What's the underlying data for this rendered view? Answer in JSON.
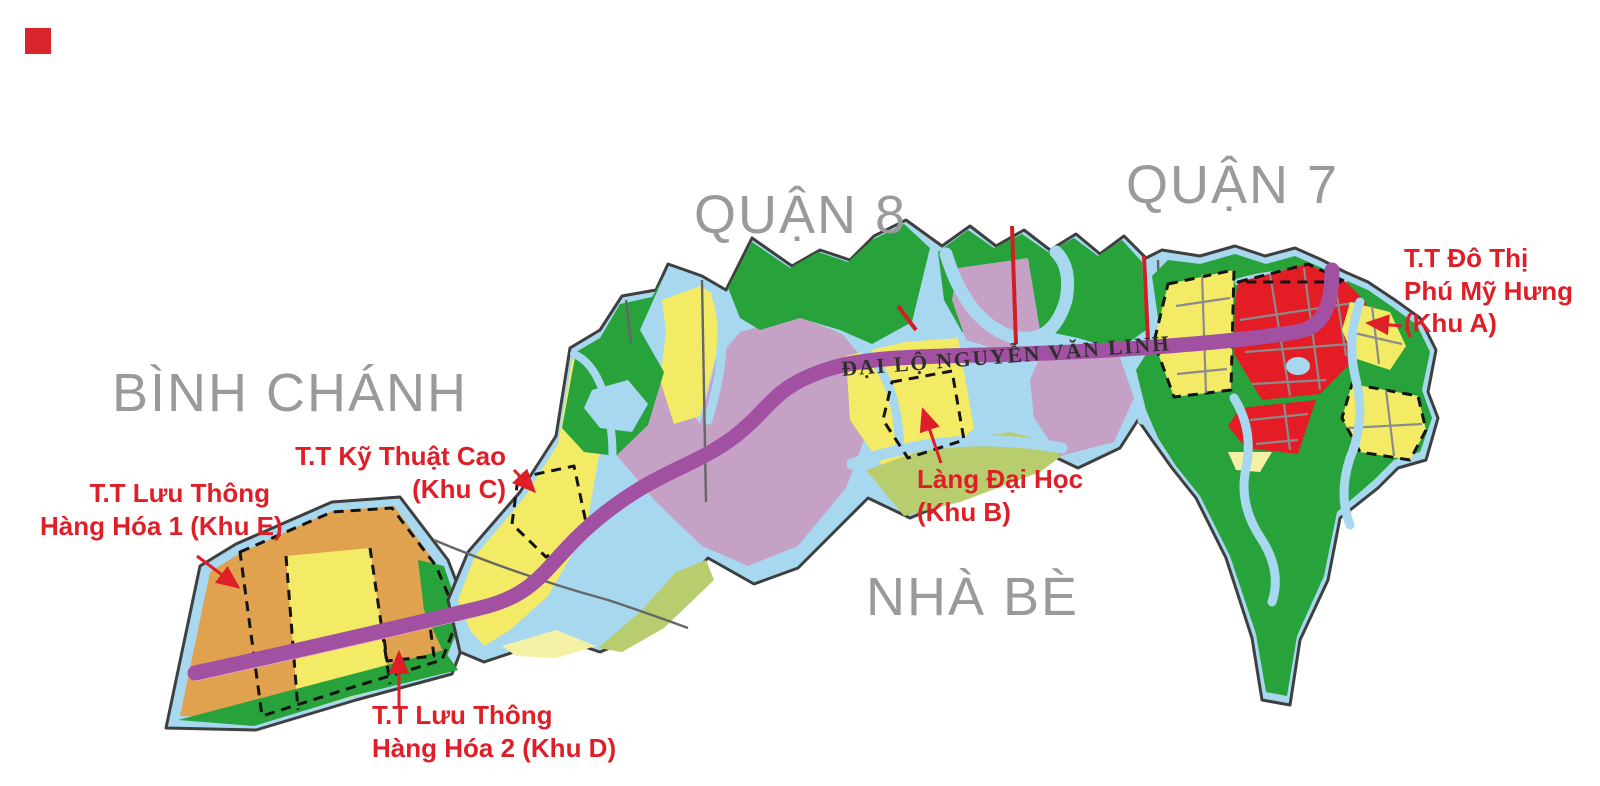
{
  "colors": {
    "water": "#a7d8ef",
    "green": "#28a23b",
    "olive": "#b7cd6e",
    "yellow": "#f3eb65",
    "pale_yellow": "#f4f0a4",
    "mauve": "#c6a1c6",
    "orange": "#e0a24f",
    "red_zone": "#e31c25",
    "boulevard": "#a251a2",
    "pink_edge": "#eba6b8",
    "red_road": "#cf1f26",
    "label_red": "#df1f28",
    "label_gray": "#9a9a9a",
    "road_text": "#2f2f2f",
    "outline": "#3f3f3f",
    "grid_gray": "#8b8b8b",
    "boundary_gray": "#666666",
    "dash_black": "#141414",
    "marker_red": "#d8262c"
  },
  "district_labels": {
    "binh_chanh": "BÌNH CHÁNH",
    "quan_8": "QUẬN 8",
    "quan_7": "QUẬN 7",
    "nha_be": "NHÀ BÈ"
  },
  "road_label": "ĐẠI LỘ NGUYỄN VĂN LINH",
  "zone_labels": {
    "khu_a": {
      "line1": "T.T Đô Thị",
      "line2": "Phú Mỹ Hưng",
      "line3": "(Khu A)"
    },
    "khu_b": {
      "line1": "Làng Đại Học",
      "line2": "(Khu B)"
    },
    "khu_c": {
      "line1": "T.T Kỹ Thuật Cao",
      "line2": "(Khu C)"
    },
    "khu_d": {
      "line1": "T.T Lưu Thông",
      "line2": "Hàng Hóa 2 (Khu D)"
    },
    "khu_e": {
      "line1": "T.T Lưu Thông",
      "line2": "Hàng Hóa 1 (Khu E)"
    }
  }
}
